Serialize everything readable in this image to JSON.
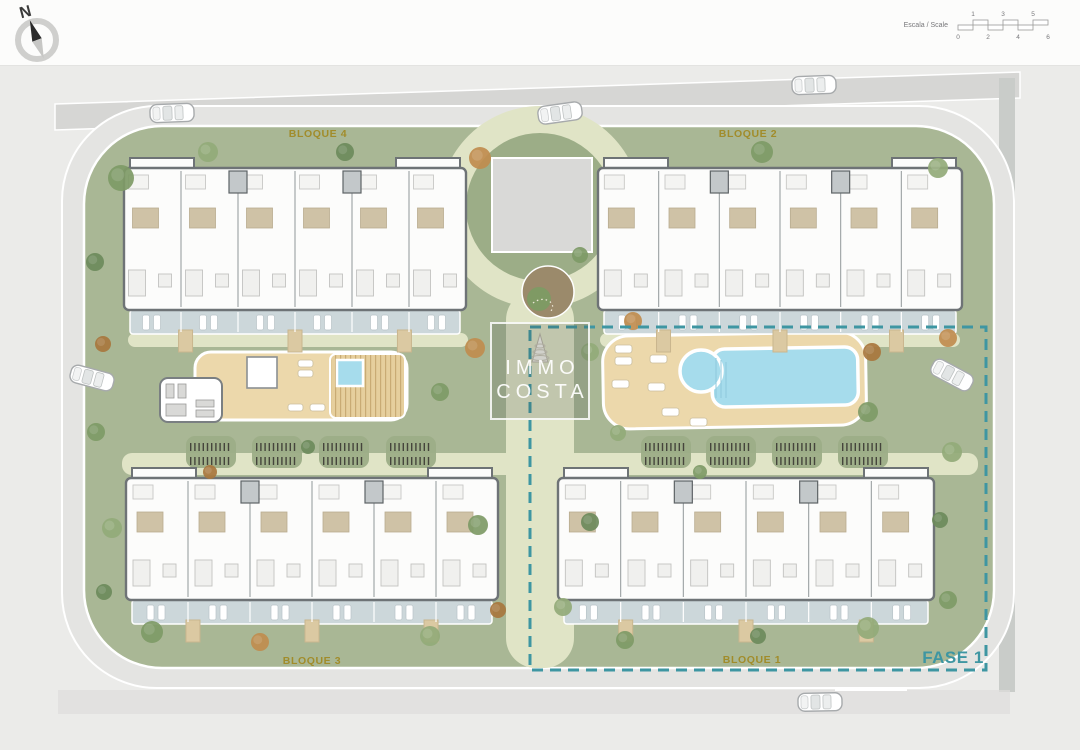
{
  "compass": {
    "label": "N"
  },
  "scale_bar": {
    "label": "Escala / Scale",
    "ticks_top": [
      "1",
      "3",
      "5"
    ],
    "ticks_bottom": [
      "0",
      "2",
      "4",
      "6"
    ]
  },
  "watermark": {
    "line1": "IMMO",
    "line2": "COSTA"
  },
  "blocks": [
    {
      "id": "bloque-4",
      "label": "BLOQUE 4"
    },
    {
      "id": "bloque-2",
      "label": "BLOQUE 2"
    },
    {
      "id": "bloque-3",
      "label": "BLOQUE 3"
    },
    {
      "id": "bloque-1",
      "label": "BLOQUE 1"
    }
  ],
  "phase": {
    "label": "FASE 1"
  },
  "colors": {
    "accent_gold": "#a18c2a",
    "phase_teal": "#3e96a2",
    "site_green": "#a9b795",
    "plaza_green": "#9cad87",
    "path_light": "#e0e4c6",
    "pool_blue": "#a6dcec",
    "deck_sand": "#ecd8ab",
    "terrace_gray_blue": "#ccd7da",
    "road_gray": "#d6d6d4",
    "background_gray": "#ebebe9"
  }
}
